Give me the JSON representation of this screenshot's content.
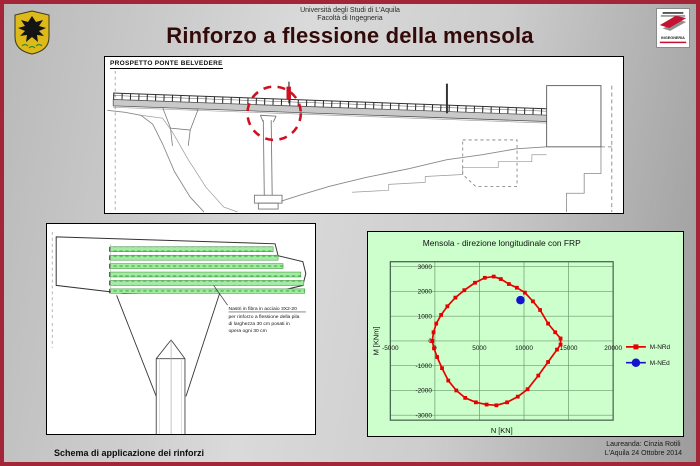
{
  "slide": {
    "university_line1": "Università degli Studi di L'Aquila",
    "university_line2": "Facoltà di Ingegneria",
    "title": "Rinforzo a flessione della mensola",
    "footer_left": "Schema di applicazione dei rinforzi",
    "footer_right_line1": "Laureanda: Cinzia Rotili",
    "footer_right_line2": "L'Aquila 24 Ottobre 2014"
  },
  "logos": {
    "crest_name": "stemma-universita-laquila",
    "faculty_logo_text": "INGEGNERIA"
  },
  "bridge_panel": {
    "label": "PROSPETTO PONTE BELVEDERE"
  },
  "detail_panel": {
    "note_line1": "Nastri in fibra in acciaio 3X2-20",
    "note_line2": "per rinforzo a flessione della pila",
    "note_line3": "di larghezza 30 cm posati in",
    "note_line4": "opera ogni 30 cm"
  },
  "chart_data": {
    "type": "scatter",
    "title": "Mensola - direzione longitudinale con FRP",
    "xlabel": "N [KN]",
    "ylabel": "M [KNm]",
    "xlim": [
      -5000,
      20000
    ],
    "ylim": [
      -3200,
      3200
    ],
    "x_ticks": [
      -5000,
      0,
      5000,
      10000,
      15000,
      20000
    ],
    "y_ticks": [
      -3000,
      -2000,
      -1000,
      0,
      1000,
      2000,
      3000
    ],
    "grid": true,
    "legend_position": "right",
    "background": "#ccffcc",
    "grid_color": "#6b9a6b",
    "series": [
      {
        "name": "M-NRd",
        "color": "#e60000",
        "marker": "square",
        "line": true,
        "points": [
          [
            -300,
            0
          ],
          [
            -150,
            350
          ],
          [
            150,
            700
          ],
          [
            700,
            1050
          ],
          [
            1400,
            1400
          ],
          [
            2300,
            1750
          ],
          [
            3300,
            2050
          ],
          [
            4500,
            2350
          ],
          [
            5600,
            2550
          ],
          [
            6600,
            2600
          ],
          [
            7400,
            2500
          ],
          [
            8300,
            2300
          ],
          [
            9200,
            2150
          ],
          [
            10100,
            1950
          ],
          [
            11000,
            1600
          ],
          [
            11800,
            1250
          ],
          [
            12700,
            700
          ],
          [
            13500,
            350
          ],
          [
            14100,
            100
          ],
          [
            14100,
            -150
          ],
          [
            13700,
            -350
          ],
          [
            12700,
            -850
          ],
          [
            11600,
            -1400
          ],
          [
            10400,
            -1950
          ],
          [
            9300,
            -2250
          ],
          [
            8100,
            -2480
          ],
          [
            6900,
            -2600
          ],
          [
            5800,
            -2570
          ],
          [
            4600,
            -2480
          ],
          [
            3400,
            -2300
          ],
          [
            2400,
            -2000
          ],
          [
            1500,
            -1600
          ],
          [
            800,
            -1100
          ],
          [
            250,
            -650
          ],
          [
            -100,
            -300
          ],
          [
            -300,
            0
          ]
        ]
      },
      {
        "name": "M-NEd",
        "color": "#1414cc",
        "marker": "circle",
        "line": false,
        "points": [
          [
            9600,
            1650
          ]
        ]
      }
    ]
  },
  "colors": {
    "frame": "#a32638",
    "title_text": "#320a0a",
    "frp_green": "#a5eba5",
    "highlight_red": "#cf1020"
  }
}
